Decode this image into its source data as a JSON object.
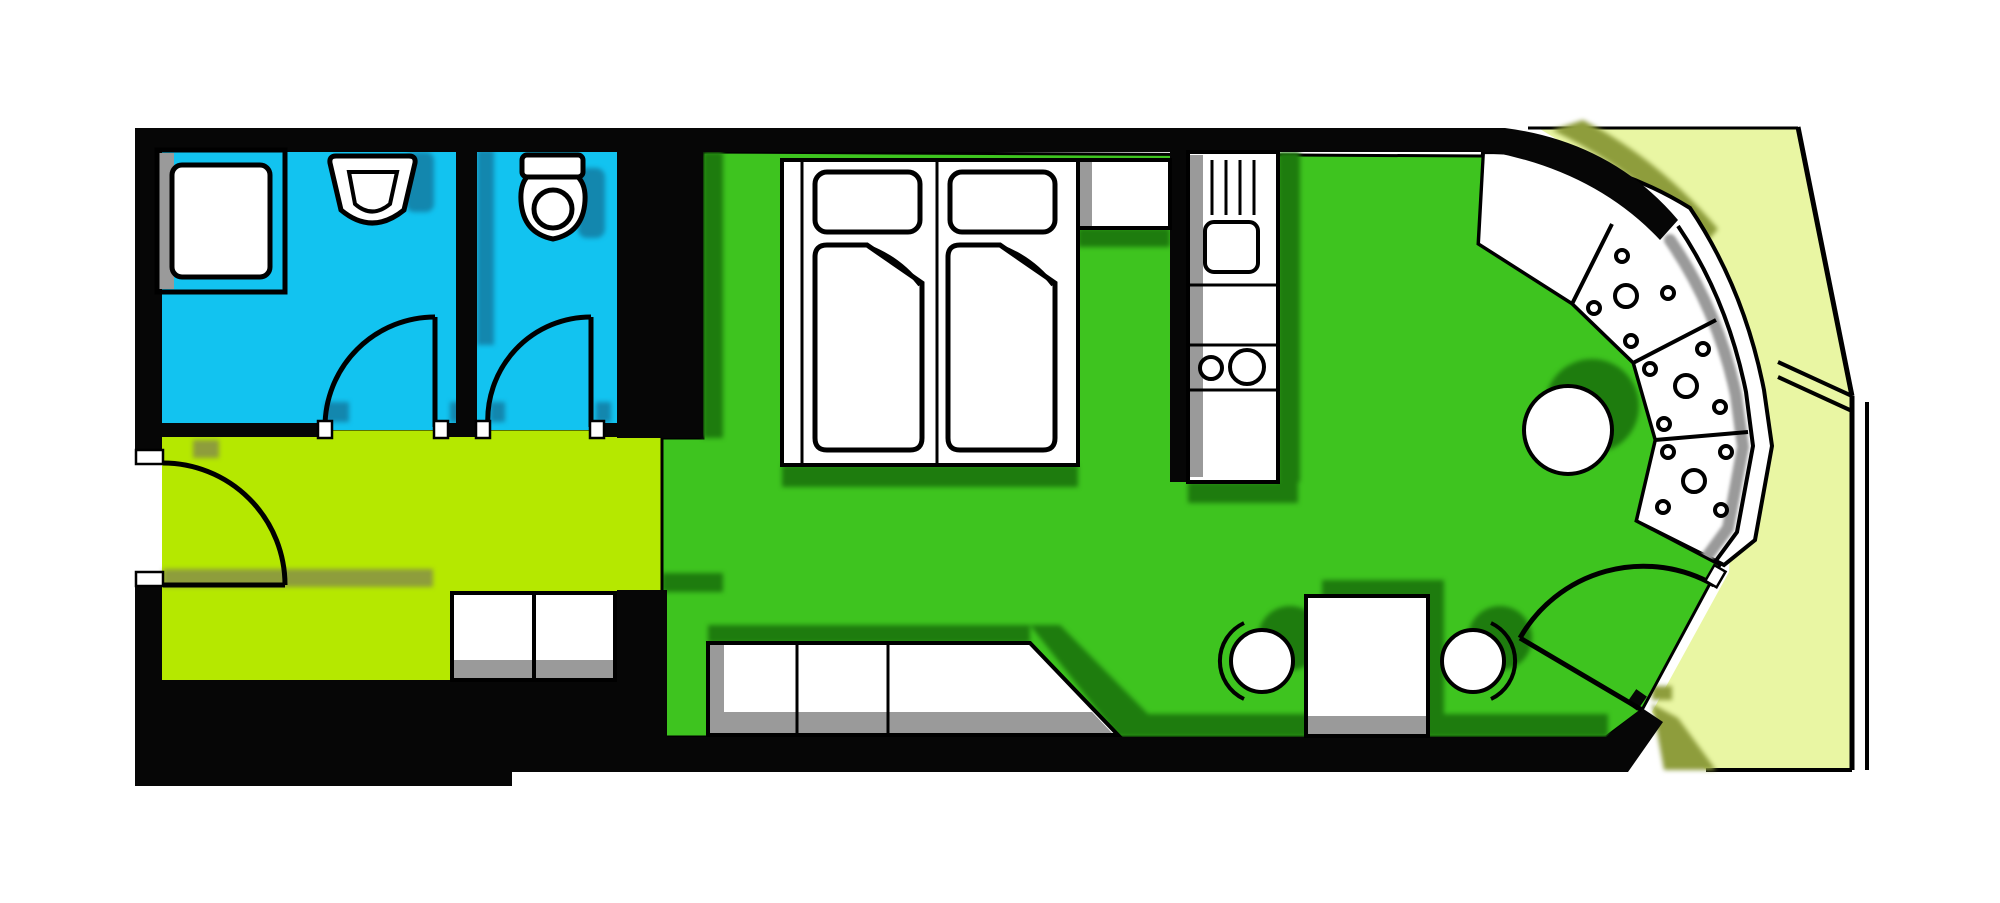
{
  "title": "apartment-floor-plan",
  "palette": {
    "wall": "#060606",
    "outline": "#000000",
    "white": "#ffffff",
    "blue": "#12c3f0",
    "teal_shadow": "#1387ae",
    "lime": "#b5e800",
    "olive_shadow": "#8e9d3c",
    "green": "#3ec41f",
    "green_shadow": "#1e7c0e",
    "balcony": "#e9f6a3",
    "gray": "#9a9a9a"
  },
  "rooms": {
    "bathroom": {
      "name": "bathroom",
      "color": "#12c3f0"
    },
    "wc": {
      "name": "wc",
      "color": "#12c3f0"
    },
    "hallway": {
      "name": "hallway",
      "color": "#b5e800"
    },
    "living_room": {
      "name": "living-sleeping-room",
      "color": "#3ec41f"
    },
    "balcony": {
      "name": "balcony",
      "color": "#e9f6a3"
    }
  },
  "furniture": [
    "shower",
    "wash-basin",
    "toilet",
    "wardrobe",
    "bed-1",
    "bed-2",
    "nightstand-shelf",
    "kitchenette",
    "stove-burners",
    "kitchen-sink",
    "sideboard-bench",
    "dining-table",
    "chair-1",
    "chair-2",
    "round-table",
    "curved-counter",
    "door-bathroom",
    "door-wc",
    "door-entry",
    "door-balcony"
  ],
  "counts": {
    "counter_segments": 4,
    "counter_big_dots": 3,
    "counter_small_dots": 12
  }
}
